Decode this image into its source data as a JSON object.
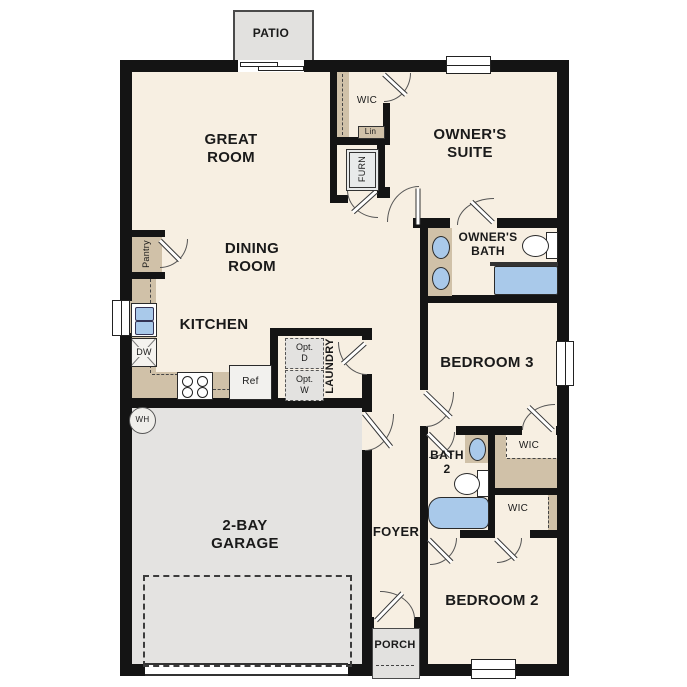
{
  "palette": {
    "wall": "#141414",
    "floor": "#f7efe2",
    "garage_floor": "#e4e3e1",
    "outdoor_grey": "#e2e1df",
    "counter_tan": "#d0c1a8",
    "fixture_blue": "#a9c9ea"
  },
  "rooms": {
    "patio": "PATIO",
    "great_room": [
      "GREAT",
      "ROOM"
    ],
    "owners_suite": [
      "OWNER'S",
      "SUITE"
    ],
    "dining_room": [
      "DINING",
      "ROOM"
    ],
    "owners_bath": [
      "OWNER'S",
      "BATH"
    ],
    "kitchen": "KITCHEN",
    "laundry": "LAUNDRY",
    "bedroom3": "BEDROOM 3",
    "bath2": [
      "BATH",
      "2"
    ],
    "garage": [
      "2-BAY",
      "GARAGE"
    ],
    "foyer": "FOYER",
    "bedroom2": "BEDROOM 2",
    "porch": "PORCH"
  },
  "closets": {
    "owners_wic": "WIC",
    "linen": "Lin",
    "furnace": "FURN",
    "pantry": "Pantry",
    "bedroom3_wic": "WIC",
    "bedroom2_wic": "WIC"
  },
  "appliances": {
    "dishwasher": "DW",
    "refrigerator": "Ref",
    "water_heater": "WH",
    "optional_dryer": [
      "Opt.",
      "D"
    ],
    "optional_washer": [
      "Opt.",
      "W"
    ]
  }
}
